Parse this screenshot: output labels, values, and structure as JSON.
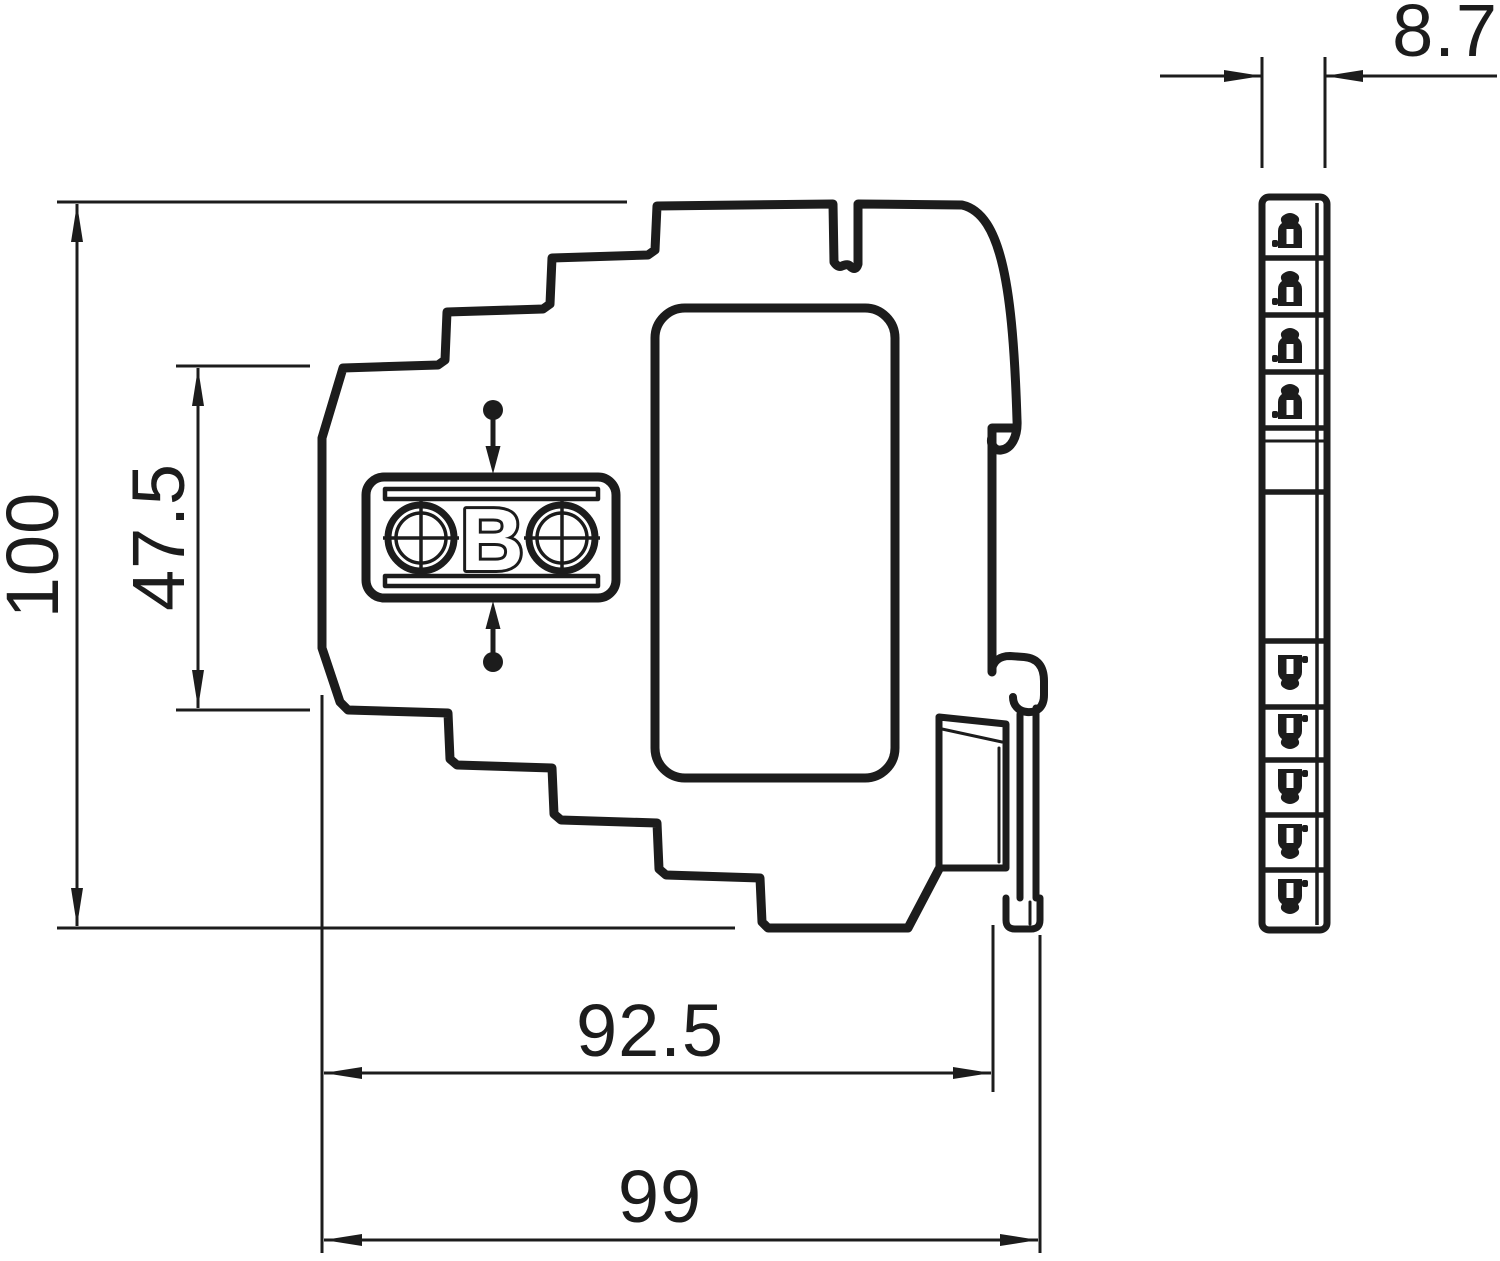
{
  "drawing": {
    "type": "technical-dimension-drawing",
    "units": "mm",
    "background": "#ffffff",
    "ink": "#1c1c1c",
    "dims": {
      "total_height": {
        "label": "100"
      },
      "partial_height": {
        "label": "47.5"
      },
      "mounting_depth": {
        "label": "92.5"
      },
      "total_depth": {
        "label": "99"
      },
      "module_width": {
        "label": "8.7"
      }
    },
    "logo": {
      "letter": "B"
    },
    "views": {
      "side_view": "stepped housing profile with label window, OBO terminal logo, snap-in direction arrows and DIN-rail clip",
      "front_view": "narrow 8.7 mm wide module face with terminal mark segments"
    }
  }
}
